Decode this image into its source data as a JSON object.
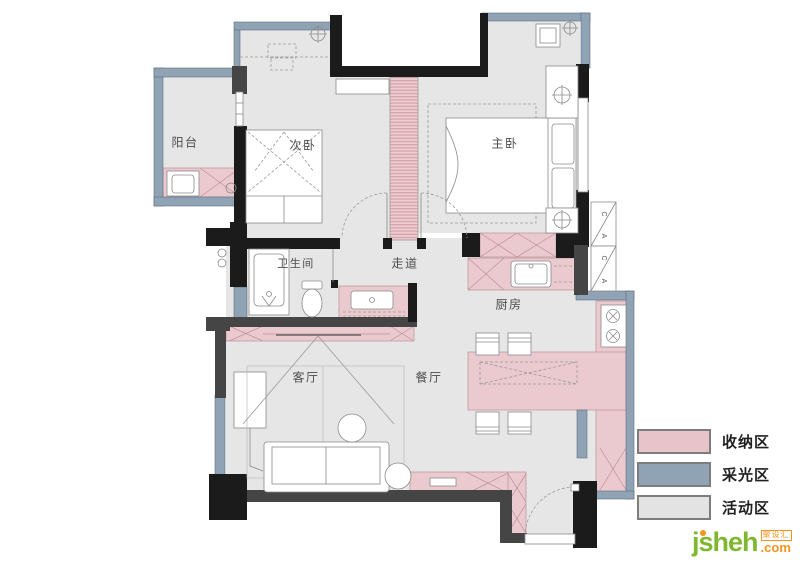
{
  "plan": {
    "rooms": [
      {
        "id": "balcony",
        "label": "阳台"
      },
      {
        "id": "bedroom-2",
        "label": "次卧"
      },
      {
        "id": "master-bedroom",
        "label": "主卧"
      },
      {
        "id": "bathroom",
        "label": "卫生间"
      },
      {
        "id": "corridor",
        "label": "走道"
      },
      {
        "id": "kitchen",
        "label": "厨房"
      },
      {
        "id": "living-room",
        "label": "客厅"
      },
      {
        "id": "dining-room",
        "label": "餐厅"
      }
    ],
    "ac_platform": {
      "cells": [
        {
          "top": "C",
          "bottom": "A"
        },
        {
          "top": "C",
          "bottom": "A"
        }
      ]
    }
  },
  "legend": {
    "items": [
      {
        "label": "收纳区",
        "color": "#e7c3ca"
      },
      {
        "label": "采光区",
        "color": "#8fa3b5"
      },
      {
        "label": "活动区",
        "color": "#e3e3e4"
      }
    ]
  },
  "logo": {
    "brand": "jsheh",
    "domain_suffix": ".com",
    "cn_name": "聚设汇"
  },
  "colors": {
    "storage": "#eac9cf",
    "daylight": "#90a3b4",
    "activity": "#e6e6e7",
    "wall_black": "#1b1b1b",
    "wall_dark": "#454545"
  }
}
